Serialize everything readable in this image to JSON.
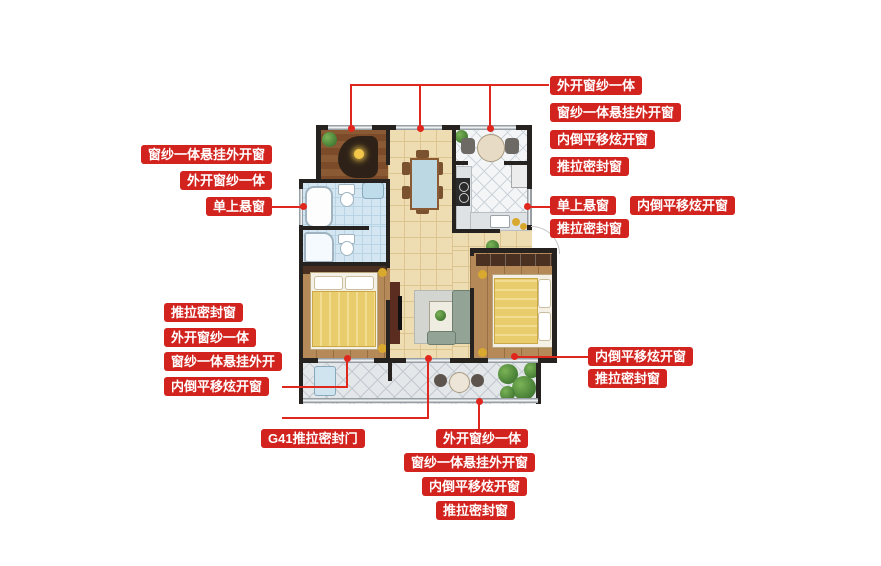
{
  "colors": {
    "label_red": "#d2231e",
    "connector_red": "#e0271e",
    "wall_black": "#262220",
    "hall_tile_tan": "#eedcb2",
    "kitchen_tile_white": "#f3f5f7",
    "bath_tile_blue": "#d3e6f2",
    "balcony_tile_gray": "#e4e7e9",
    "bedroom_wood": "#b68a58",
    "bed_quilt_yellow": "#e9cd6d"
  },
  "annotations": {
    "top_right": {
      "items": [
        "外开窗纱一体",
        "窗纱一体悬挂外开窗",
        "内倒平移炫开窗",
        "推拉密封窗"
      ]
    },
    "right_mid": {
      "items": [
        "单上悬窗",
        "内倒平移炫开窗",
        "推拉密封窗"
      ]
    },
    "left_top": {
      "items": [
        "窗纱一体悬挂外开窗",
        "外开窗纱一体",
        "单上悬窗"
      ]
    },
    "left_bottom": {
      "items": [
        "推拉密封窗",
        "外开窗纱一体",
        "窗纱一体悬挂外开",
        "内倒平移炫开窗"
      ]
    },
    "bottom_left": {
      "door_label": "G41推拉密封门"
    },
    "bottom_center": {
      "items": [
        "外开窗纱一体",
        "窗纱一体悬挂外开窗",
        "内倒平移炫开窗",
        "推拉密封窗"
      ]
    },
    "right_bottom": {
      "items": [
        "内倒平移炫开窗",
        "推拉密封窗"
      ]
    }
  }
}
